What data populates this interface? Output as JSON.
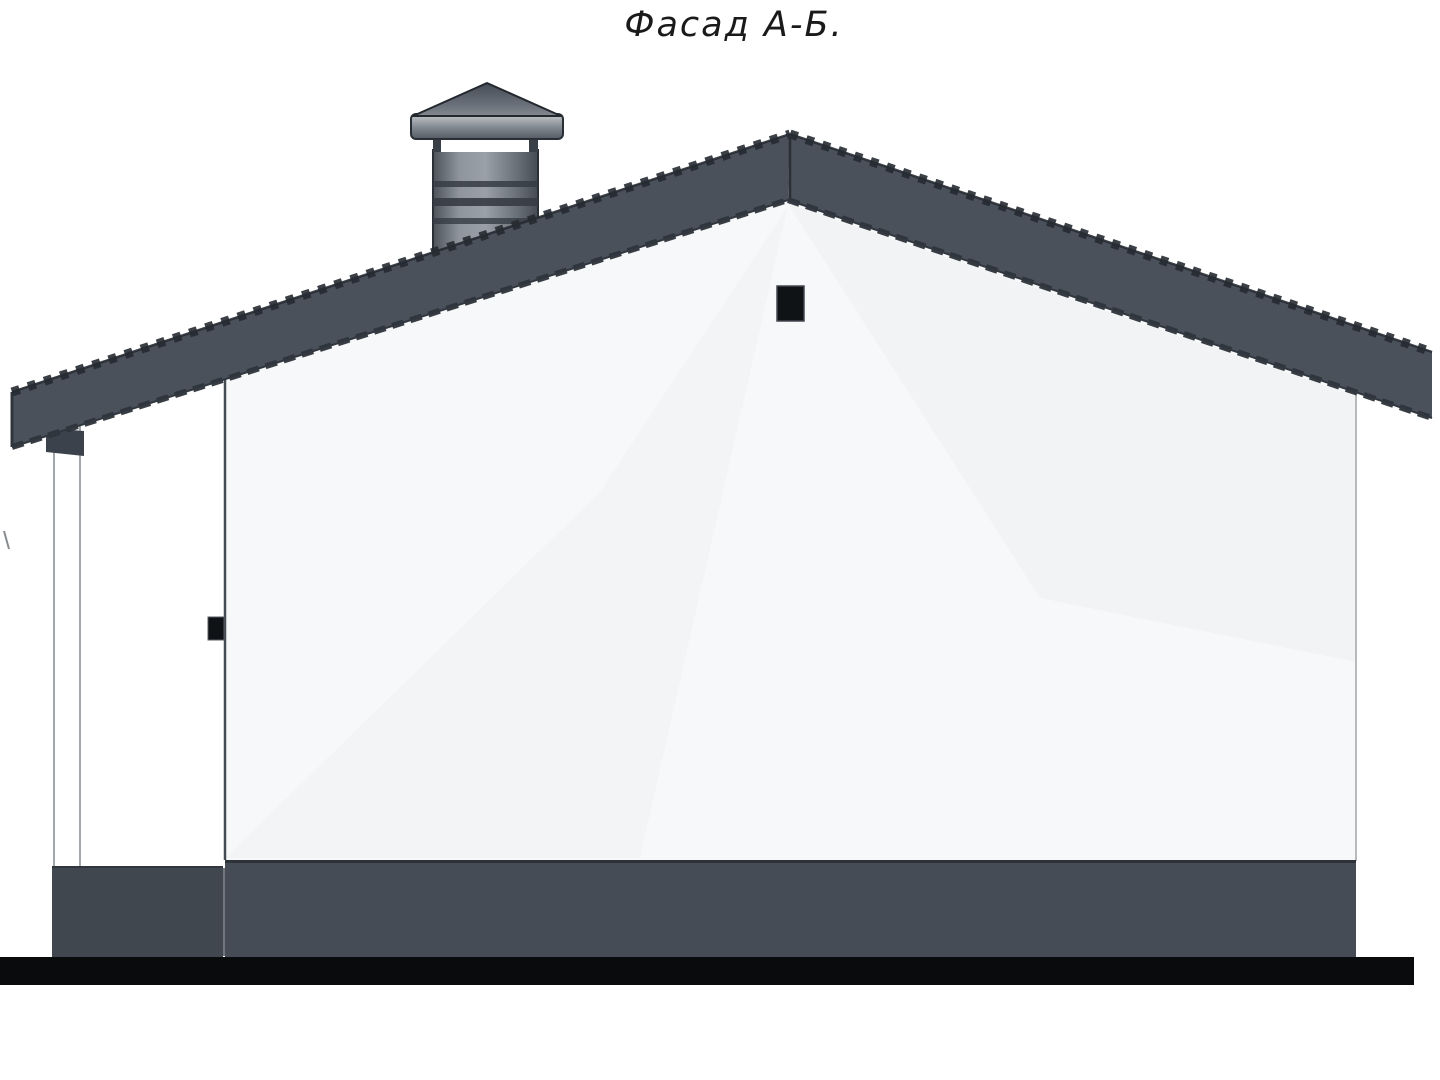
{
  "title": "Фасад А-Б.",
  "colors": {
    "roof": "#4a515b",
    "roof_edge": "#262b32",
    "roof_underside": "#2e343b",
    "wall": "#f7f8f9",
    "wall_edge_dark": "#454b52",
    "wall_edge_light": "#b6babd",
    "vent": "#101316",
    "handle": "#101316",
    "bracket": "#3c424b",
    "base_main": "#454c55",
    "base_porch": "#40474f",
    "ground": "#0a0b0c"
  }
}
